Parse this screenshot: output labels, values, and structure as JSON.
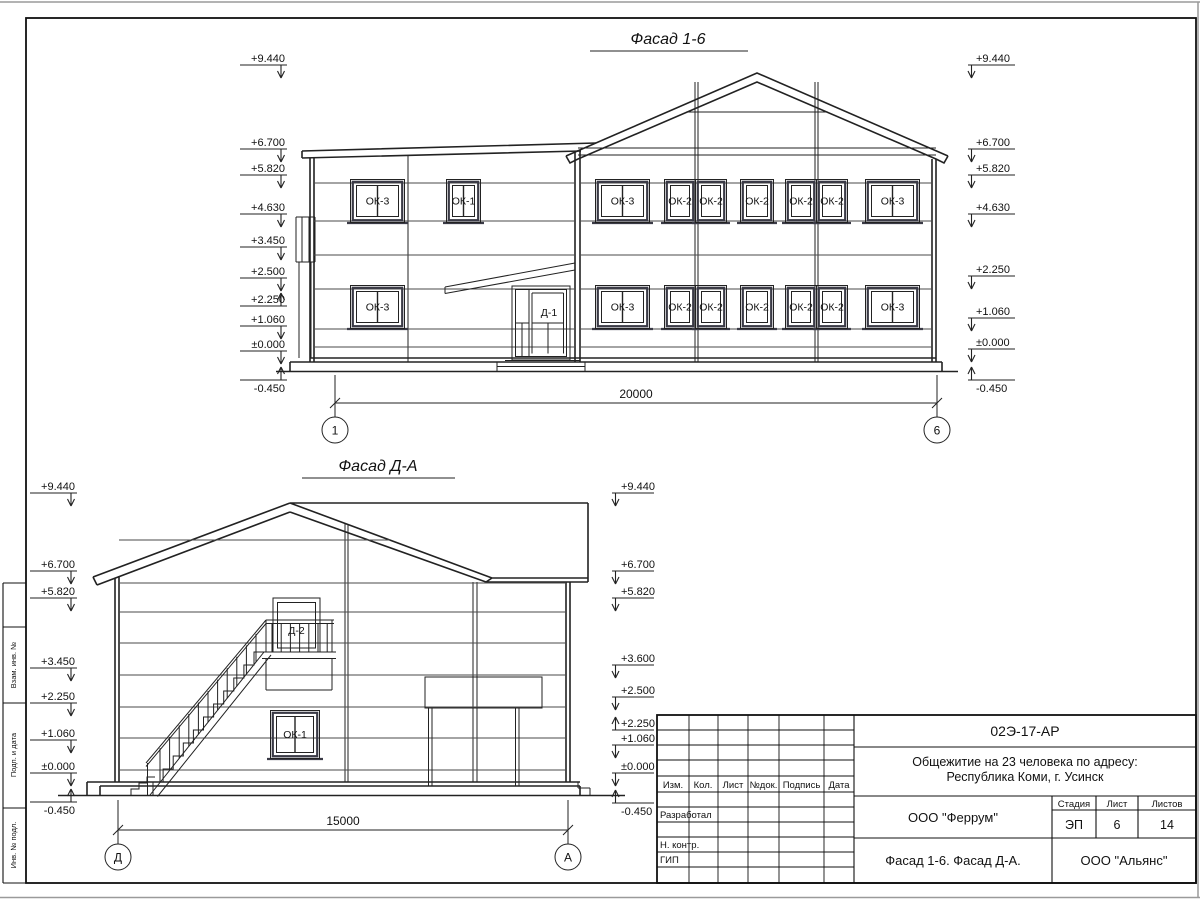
{
  "sheet": {
    "side_labels": [
      "Взам. инв. №",
      "Подп. и дата",
      "Инв. № подл."
    ],
    "title_block": {
      "doc_number": "02Э-17-АР",
      "project_line1": "Общежитие на 23 человека по адресу:",
      "project_line2": "Республика Коми, г. Усинск",
      "columns": [
        "Изм.",
        "Кол.",
        "Лист",
        "№док.",
        "Подпись",
        "Дата"
      ],
      "row_labels": [
        "Разработал",
        "Н. контр.",
        "ГИП"
      ],
      "developer_org": "ООО \"Феррум\"",
      "stage_label": "Стадия",
      "sheet_label": "Лист",
      "sheets_label": "Листов",
      "stage_value": "ЭП",
      "sheet_value": "6",
      "sheets_value": "14",
      "drawing_title": "Фасад 1-6. Фасад Д-А.",
      "general_org": "ООО \"Альянс\""
    }
  },
  "facade16": {
    "title": "Фасад 1-6",
    "marks_left": [
      "+9.440",
      "+6.700",
      "+5.820",
      "+4.630",
      "+3.450",
      "+2.500",
      "+2.250",
      "+1.060",
      "±0.000",
      "-0.450"
    ],
    "marks_right": [
      "+9.440",
      "+6.700",
      "+5.820",
      "+4.630",
      "+2.250",
      "+1.060",
      "±0.000",
      "-0.450"
    ],
    "windows_top": [
      "ОК-3",
      "ОК-1",
      "ОК-3",
      "ОК-2",
      "ОК-2",
      "ОК-2",
      "ОК-2",
      "ОК-2",
      "ОК-3"
    ],
    "windows_bottom": [
      "ОК-3",
      "ОК-3",
      "ОК-2",
      "ОК-2",
      "ОК-2",
      "ОК-2",
      "ОК-2",
      "ОК-3"
    ],
    "door_label": "Д-1",
    "dimension": "20000",
    "axis_left": "1",
    "axis_right": "6"
  },
  "facadeDA": {
    "title": "Фасад Д-А",
    "marks_left": [
      "+9.440",
      "+6.700",
      "+5.820",
      "+3.450",
      "+2.250",
      "+1.060",
      "±0.000",
      "-0.450"
    ],
    "marks_right": [
      "+9.440",
      "+6.700",
      "+5.820",
      "+3.600",
      "+2.500",
      "+2.250",
      "+1.060",
      "±0.000",
      "-0.450"
    ],
    "door_label": "Д-2",
    "window_label": "ОК-1",
    "dimension": "15000",
    "axis_left": "Д",
    "axis_right": "А"
  }
}
